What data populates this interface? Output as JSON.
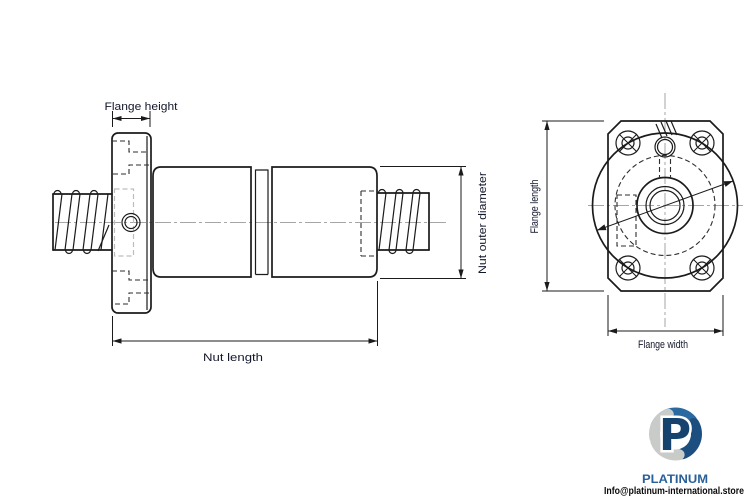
{
  "page": {
    "background": "#ffffff"
  },
  "colors": {
    "line": "#1b1b1b",
    "centerline": "#a6a6a6",
    "hidden_line": "#2e2e2e",
    "light_track": "#bdbdbd",
    "label": "#12172b",
    "brand_blue": "#2a6099",
    "logo_navy": "#16426e",
    "logo_blue": "#2a6aa0",
    "logo_gray": "#c9cbc9",
    "email_black": "#0b0b0b"
  },
  "diagram": {
    "side_view": {
      "dim_labels": {
        "flange_height": "Flange height",
        "nut_outer_diameter": "Nut outer diameter",
        "nut_length": "Nut length"
      }
    },
    "front_view": {
      "dim_labels": {
        "flange_length": "Flange length",
        "flange_width": "Flange width"
      }
    }
  },
  "branding": {
    "name": "PLATINUM",
    "email": "Info@platinum-international.store"
  }
}
